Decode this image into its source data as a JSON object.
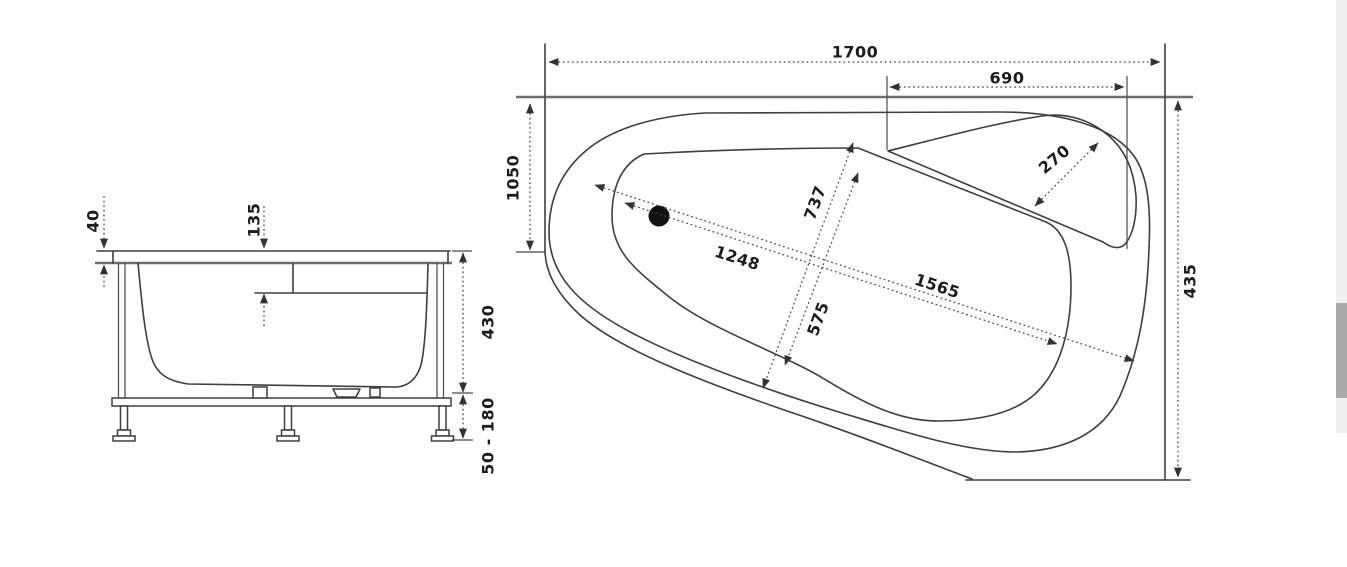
{
  "diagram": {
    "title": "bathtub-technical-drawing",
    "line_color": "#3f3f3f",
    "accent_line_color": "#6f6f6f",
    "drain_color": "#101010",
    "side_view": {
      "name": "side-elevation",
      "dims": {
        "rim_height": "40",
        "seat_depth": "135",
        "body_height": "430",
        "leg_height_range": "50 - 180"
      }
    },
    "plan_view": {
      "name": "top-plan",
      "dims": {
        "overall_length": "1700",
        "corner_shelf_length": "690",
        "left_side": "1050",
        "right_side": "435",
        "rim_length": "1565",
        "basin_length": "1248",
        "rim_width": "737",
        "basin_width": "575",
        "shelf_depth": "270"
      }
    },
    "icons": {
      "drain": "filled-circle"
    }
  },
  "scrollbar": {
    "track_color": "#f0f0f0",
    "thumb_color": "#a9a9a9"
  }
}
